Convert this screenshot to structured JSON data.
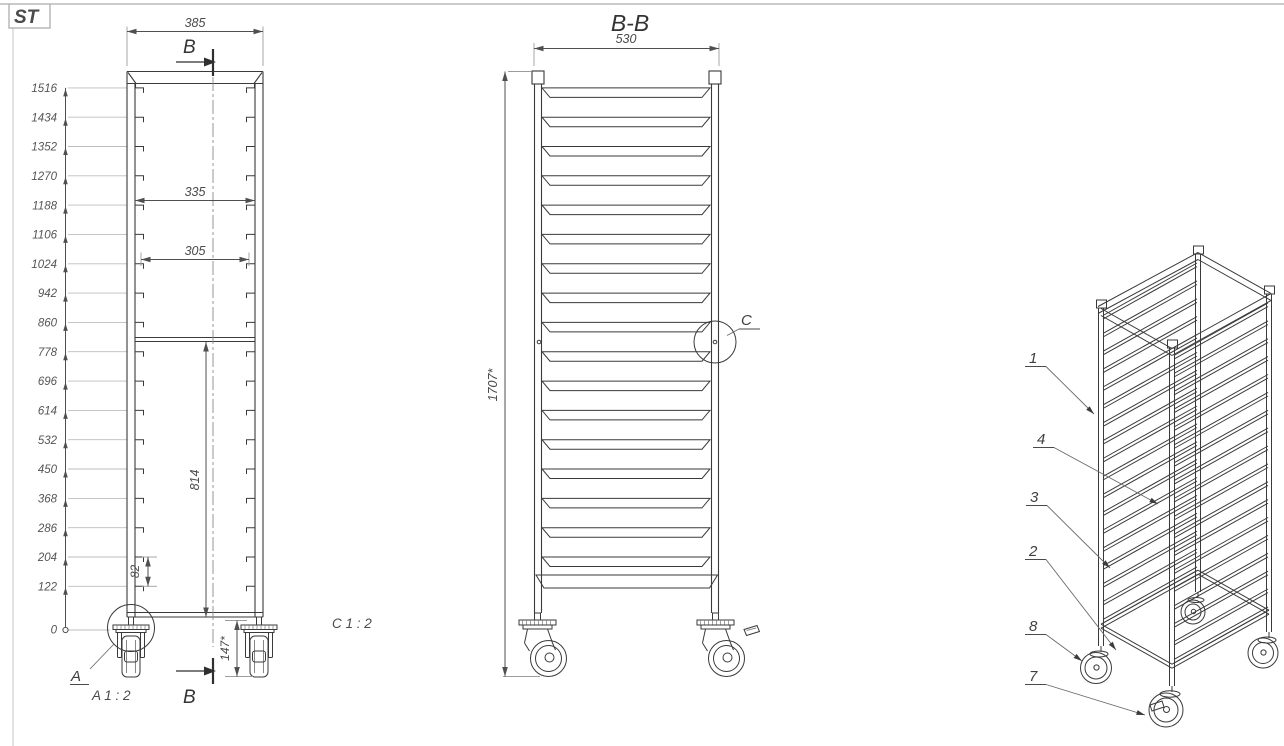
{
  "logo": {
    "text": "ST",
    "color": "#cc2522"
  },
  "front_view": {
    "width_dim": "385",
    "inner_width_dim": "335",
    "rail_width_dim": "305",
    "height_dim": "814",
    "pitch_dim": "82",
    "caster_height_dim": "147*",
    "section_label_top": "B",
    "section_label_bottom": "B",
    "detail_label": "A",
    "detail_scale": "A 1 : 2",
    "detail_c_scale_note": "C 1 : 2",
    "ladder": [
      "1516",
      "1434",
      "1352",
      "1270",
      "1188",
      "1106",
      "1024",
      "942",
      "860",
      "778",
      "696",
      "614",
      "532",
      "450",
      "368",
      "286",
      "204",
      "122",
      "0"
    ]
  },
  "section_view": {
    "title": "B-B",
    "width_dim": "530",
    "height_dim": "1707*",
    "detail_label": "C"
  },
  "isometric_view": {
    "callouts": [
      "1",
      "4",
      "3",
      "2",
      "8",
      "7"
    ]
  }
}
